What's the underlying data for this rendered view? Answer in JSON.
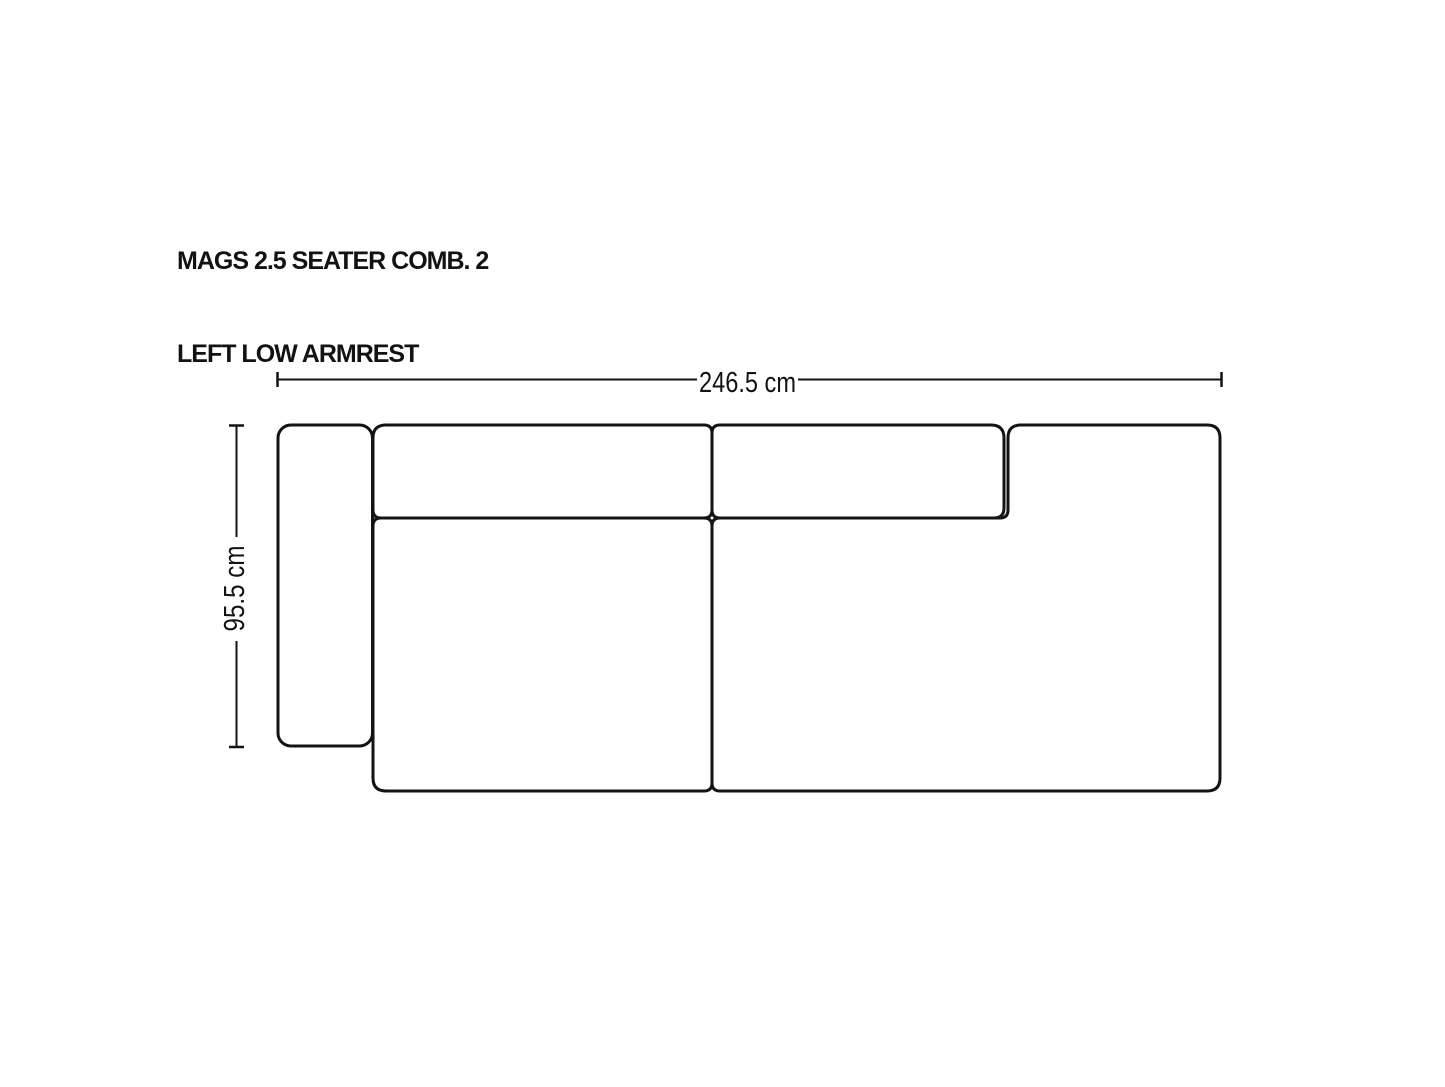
{
  "title": {
    "line1": "MAGS 2.5 SEATER COMB. 2",
    "line2": "LEFT LOW ARMREST"
  },
  "dimensions": {
    "width": "246.5 cm",
    "depth": "95.5 cm"
  },
  "diagram": {
    "type": "sofa-top-view-line-drawing",
    "modules": [
      "left-low-armrest",
      "left-backrest-cushion",
      "right-backrest-cushion",
      "left-seat-module",
      "right-seat-chaise-module"
    ]
  },
  "colors": {
    "line": "#131313",
    "background": "#ffffff"
  }
}
